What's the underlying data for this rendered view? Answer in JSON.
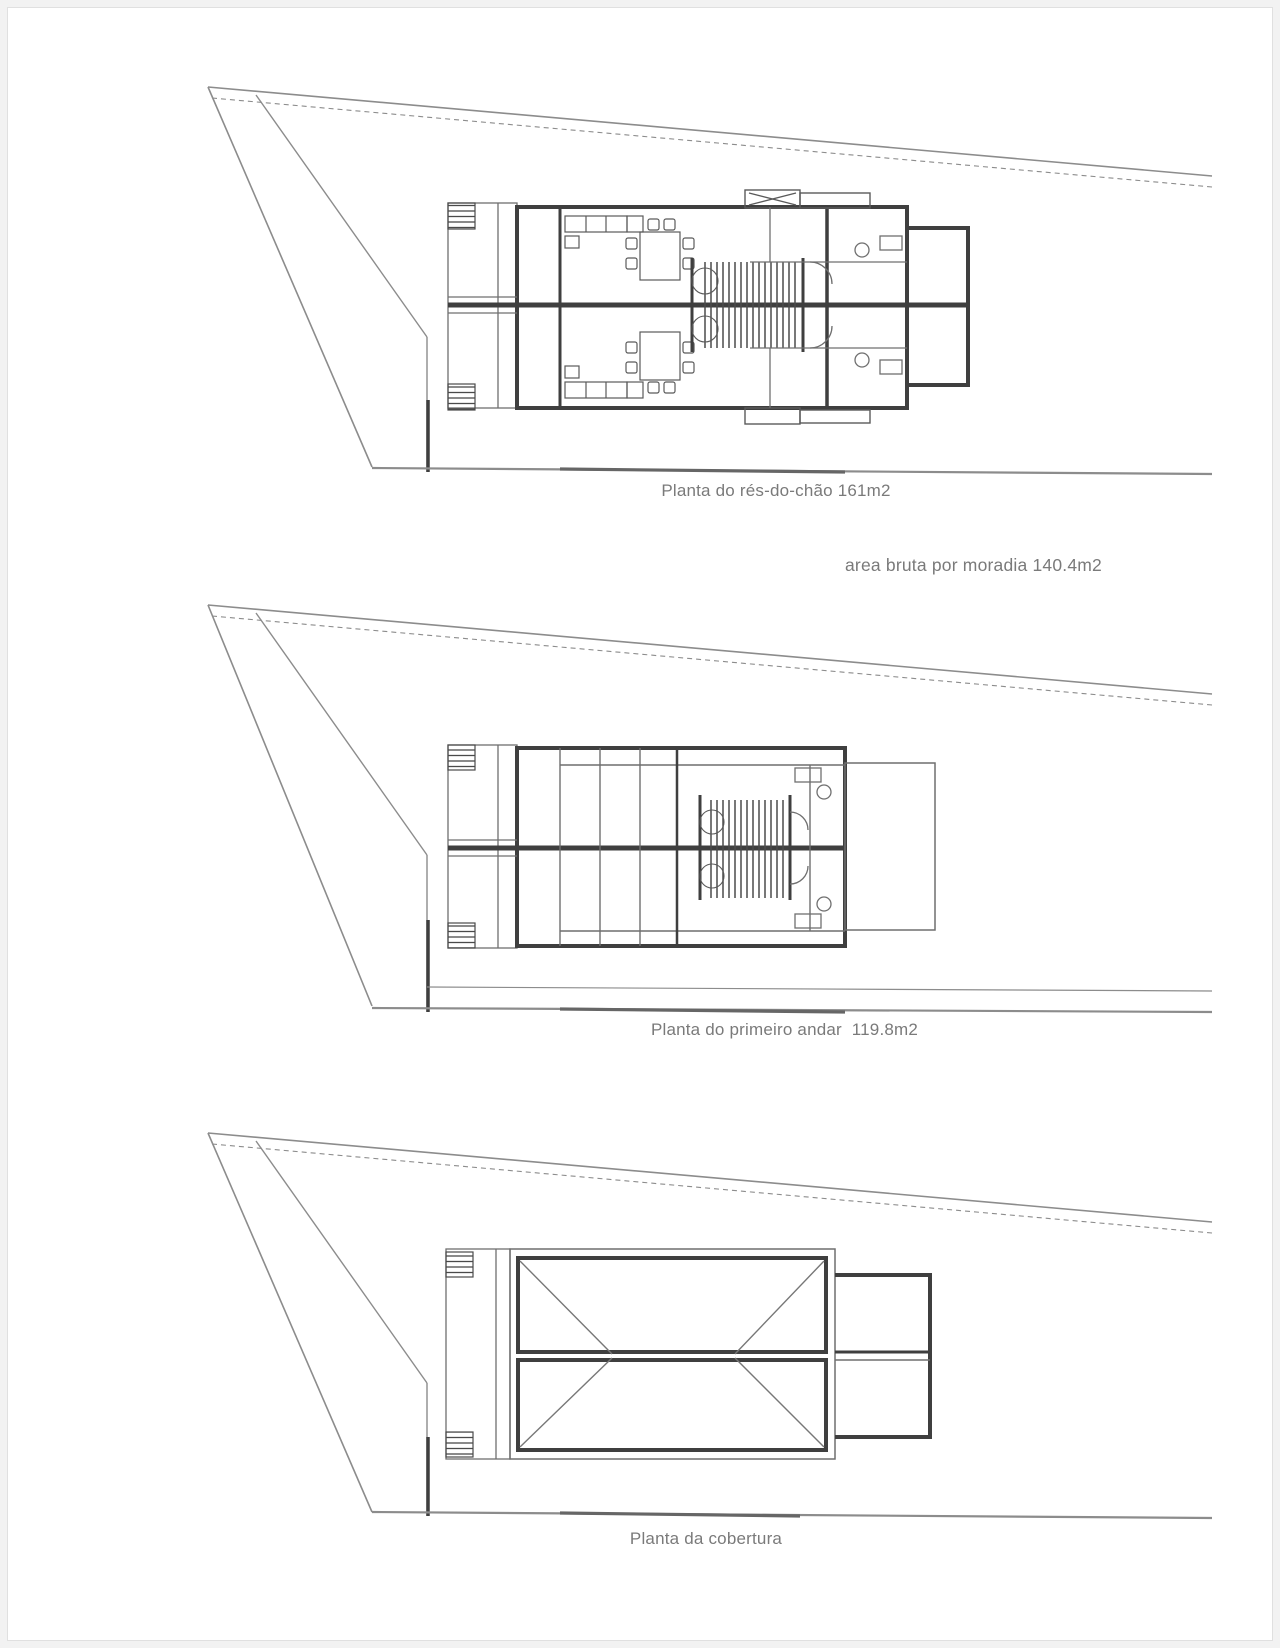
{
  "page": {
    "background": "#ffffff",
    "frame_color": "#e0e0e0",
    "wall_color": "#3f3f3f",
    "thin_line_color": "#6f6f6f",
    "site_line_color": "#8c8c8c",
    "text_color": "#7a7a7a"
  },
  "plans": [
    {
      "id": "ground-floor",
      "caption": "Planta do rés-do-chão 161m2"
    },
    {
      "id": "first-floor",
      "caption": "Planta do primeiro andar  119.8m2"
    },
    {
      "id": "roof",
      "caption": "Planta da cobertura"
    }
  ],
  "annotation": {
    "text": "area bruta por moradia 140.4m2"
  }
}
